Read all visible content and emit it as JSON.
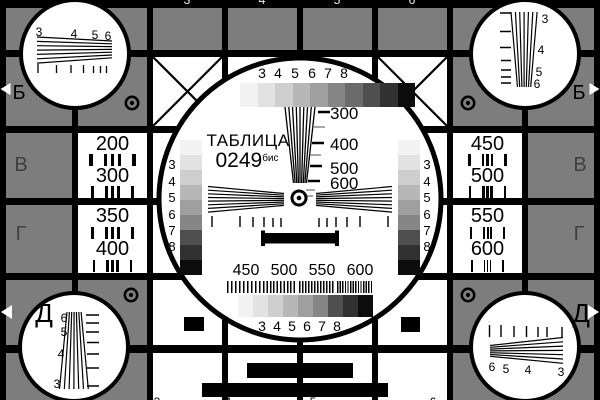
{
  "card": {
    "title_line1": "ТАБЛИЦА",
    "title_line2": "0249",
    "title_superscript": "бис"
  },
  "side_labels": {
    "left": [
      "Б",
      "В",
      "Г",
      "Д"
    ],
    "right": [
      "Б",
      "В",
      "Г",
      "Д"
    ]
  },
  "line_frequency_cells": {
    "left_top": [
      "200",
      "300"
    ],
    "left_bottom": [
      "350",
      "400"
    ],
    "right_top": [
      "450",
      "500"
    ],
    "right_bottom": [
      "550",
      "600"
    ]
  },
  "central_circle": {
    "top_grayscale_labels": [
      "3",
      "4",
      "5",
      "6",
      "7",
      "8"
    ],
    "bottom_grayscale_labels": [
      "3",
      "4",
      "5",
      "6",
      "7",
      "8"
    ],
    "left_grayscale_labels": [
      "3",
      "4",
      "5",
      "6",
      "7",
      "8"
    ],
    "right_grayscale_labels": [
      "3",
      "4",
      "5",
      "6",
      "7",
      "8"
    ],
    "vertical_wedge_labels": [
      "300",
      "400",
      "500",
      "600"
    ],
    "bottom_frequency_labels": [
      "450",
      "500",
      "550",
      "600"
    ]
  },
  "corner_circles": {
    "top_left_labels": [
      "3",
      "4",
      "5",
      "6"
    ],
    "top_right_labels": [
      "3",
      "4",
      "5",
      "6"
    ],
    "bottom_left_labels": [
      "6",
      "5",
      "4",
      "3"
    ],
    "bottom_right_labels": [
      "6",
      "5",
      "4",
      "3"
    ]
  },
  "border_strips": {
    "top_digit_fragments": [
      "3",
      "4",
      "5",
      "6"
    ],
    "bottom_digit_fragments": [
      "3",
      "4",
      "5",
      "6"
    ]
  },
  "colors": {
    "background_gray": "#7d7d7d",
    "black": "#000000",
    "white": "#ffffff",
    "letter_gray": "#3f3f3f",
    "grayscale_ramp": [
      "#f2f2f2",
      "#e2e2e2",
      "#cecece",
      "#b7b7b7",
      "#9f9f9f",
      "#868686",
      "#6b6b6b",
      "#4f4f4f",
      "#313131",
      "#0d0d0d"
    ]
  }
}
